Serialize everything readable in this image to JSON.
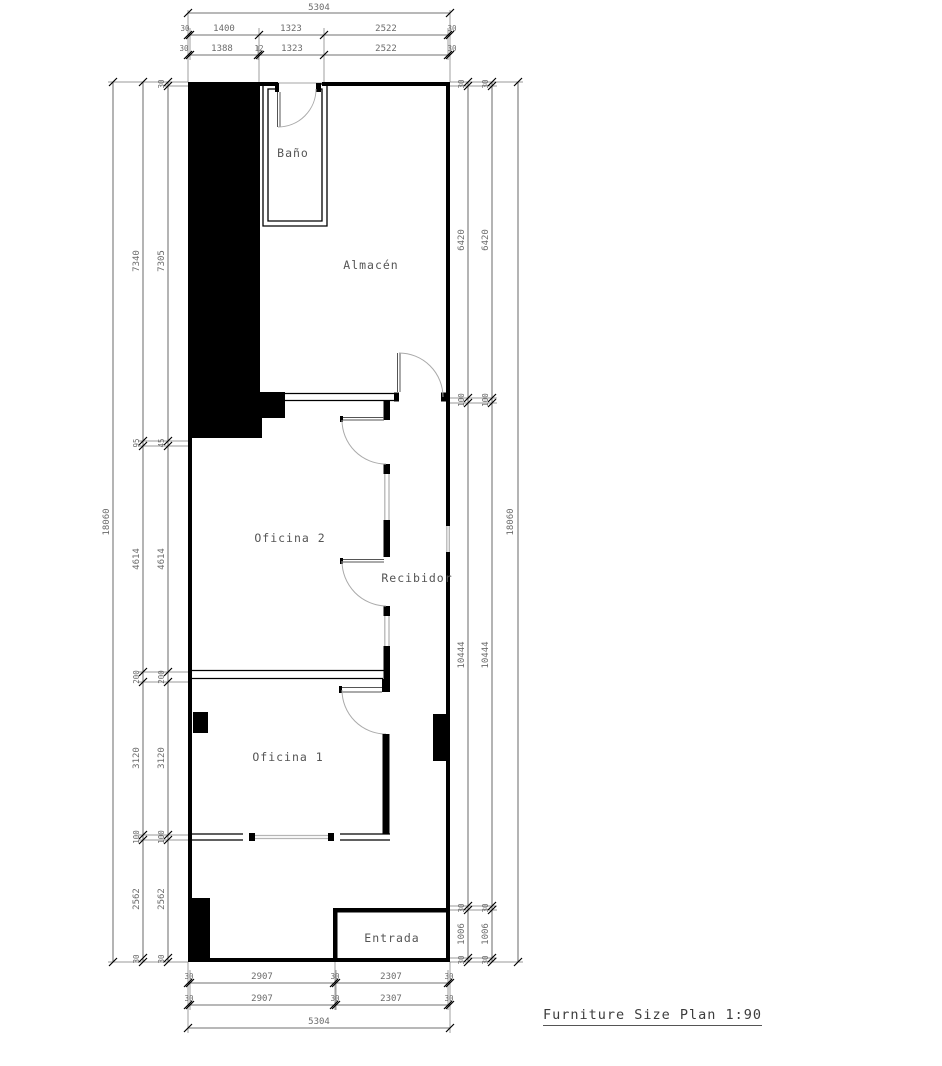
{
  "meta": {
    "title_block": "Furniture Size Plan 1:90"
  },
  "rooms": {
    "bano": "Baño",
    "almacen": "Almacén",
    "oficina2": "Oficina 2",
    "recibidor": "Recibidor",
    "oficina1": "Oficina 1",
    "entrada": "Entrada"
  },
  "dims": {
    "top": {
      "overall": "5304",
      "row2": [
        "30",
        "1400",
        "1323",
        "2522",
        "30"
      ],
      "row3": [
        "30",
        "1388",
        "12",
        "1323",
        "2522",
        "30"
      ]
    },
    "bottom": {
      "row1": [
        "30",
        "2907",
        "30",
        "2307",
        "30"
      ],
      "row2": [
        "30",
        "2907",
        "30",
        "2307",
        "30"
      ],
      "overall": "5304"
    },
    "left": {
      "overall": "18060",
      "col2": [
        "7340",
        "95",
        "4614",
        "200",
        "3120",
        "100",
        "2562",
        "30"
      ],
      "col3": [
        "30",
        "7305",
        "45",
        "4614",
        "200",
        "3120",
        "100",
        "2562",
        "30"
      ]
    },
    "right": {
      "col1": [
        "30",
        "6420",
        "100",
        "10444",
        "30",
        "1006",
        "30"
      ],
      "col2": [
        "30",
        "6420",
        "100",
        "10444",
        "30",
        "1006",
        "30"
      ],
      "overall": "18060"
    }
  },
  "colors": {
    "wall": "#000000",
    "dim_line": "#444444",
    "dim_text": "#6b6b6b",
    "room_text": "#555555",
    "window": "#b5b5b5",
    "door_arc": "#aaaaaa"
  }
}
